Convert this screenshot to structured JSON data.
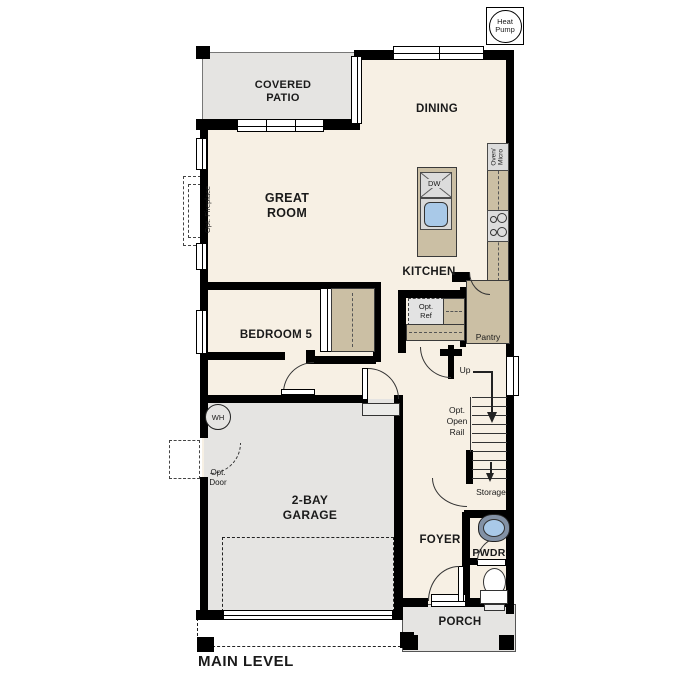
{
  "title": "MAIN LEVEL",
  "badges": {
    "heat_pump": "Heat\nPump"
  },
  "rooms": {
    "covered_patio": "COVERED\nPATIO",
    "dining": "DINING",
    "great_room": "GREAT\nROOM",
    "kitchen": "KITCHEN",
    "bedroom5": "BEDROOM 5",
    "garage": "2-BAY\nGARAGE",
    "foyer": "FOYER",
    "pwdr": "PWDR",
    "porch": "PORCH"
  },
  "features": {
    "opt_fireplace": "Opt. Fireplace",
    "oven_micro": "Oven/\nMicro",
    "dw": "DW",
    "opt_ref": "Opt.\nRef",
    "pantry": "Pantry",
    "up": "Up",
    "opt_open_rail": "Opt.\nOpen\nRail",
    "storage": "Storage",
    "wh": "WH",
    "opt_door": "Opt.\nDoor"
  },
  "colors": {
    "wall": "#000000",
    "interior_floor": "#f7f0e4",
    "outdoor_floor": "#e5e4e2",
    "counter": "#cbbfa4",
    "appliance": "#dcdcdc",
    "sink": "#a9c9e8"
  }
}
